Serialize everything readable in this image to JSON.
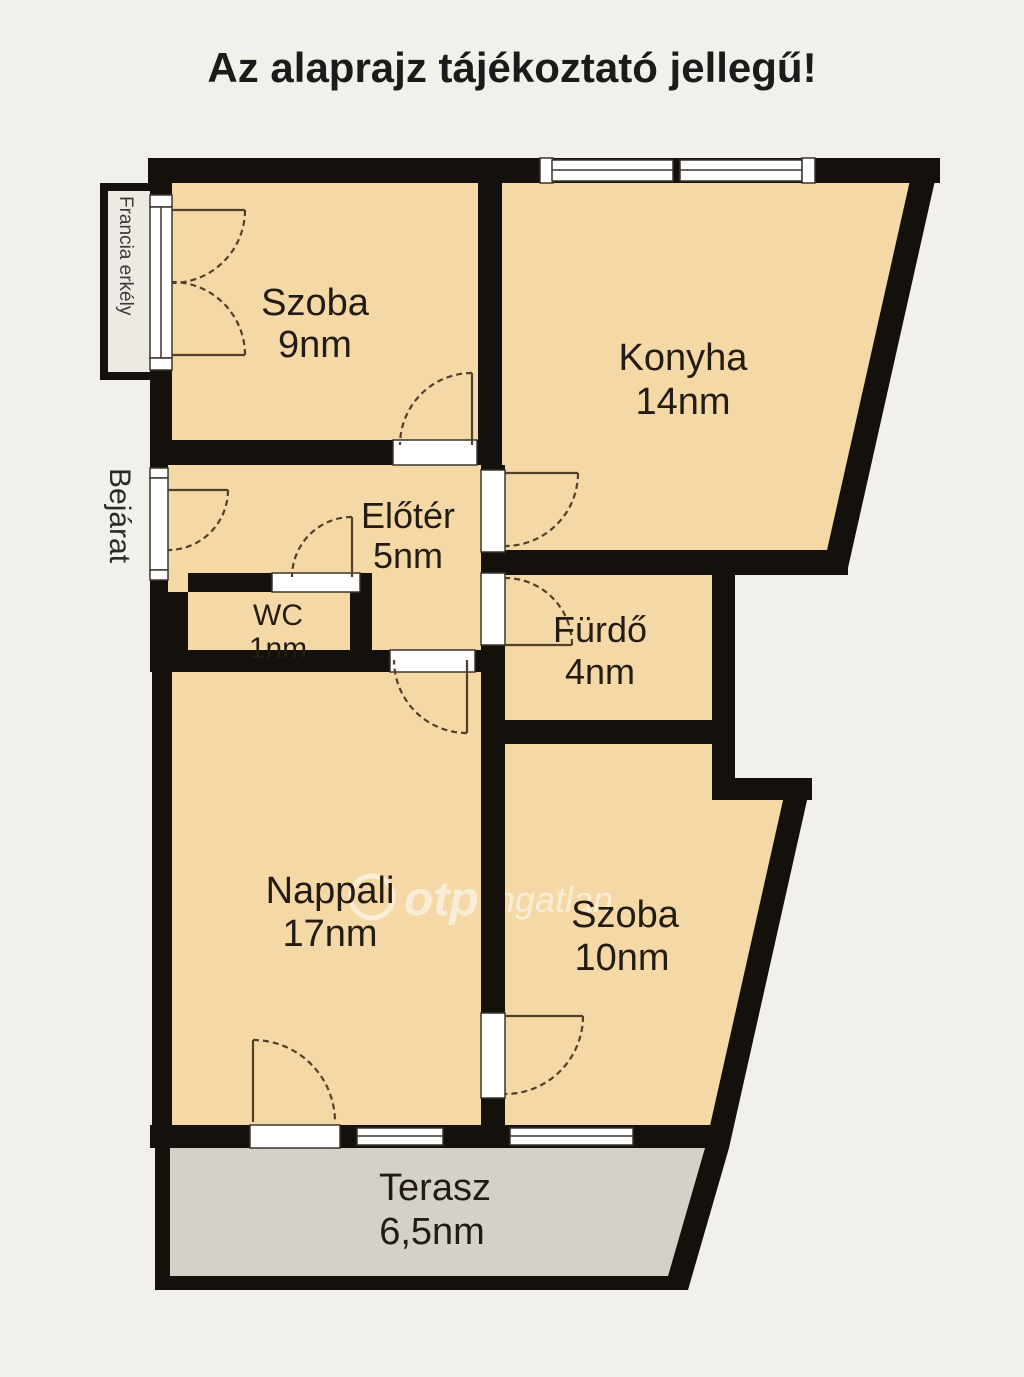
{
  "title": "Az alaprajz tájékoztató jellegű!",
  "rooms": {
    "szoba9": {
      "name": "Szoba",
      "area": "9nm"
    },
    "konyha": {
      "name": "Konyha",
      "area": "14nm"
    },
    "eloter": {
      "name": "Előtér",
      "area": "5nm"
    },
    "wc": {
      "name": "WC",
      "area": "1nm"
    },
    "furdo": {
      "name": "Fürdő",
      "area": "4nm"
    },
    "nappali": {
      "name": "Nappali",
      "area": "17nm"
    },
    "szoba10": {
      "name": "Szoba",
      "area": "10nm"
    },
    "terasz": {
      "name": "Terasz",
      "area": "6,5nm"
    }
  },
  "labels": {
    "entrance": "Bejárat",
    "french_balcony": "Francia erkély"
  },
  "watermark": {
    "brand": "otp",
    "suffix": "ingatlan"
  },
  "colors": {
    "room_fill": "#f4d9a6",
    "terrace_fill": "#d4d1c8",
    "balcony_fill": "#eceae3",
    "wall": "#14110d",
    "background": "#f2f0ea"
  }
}
